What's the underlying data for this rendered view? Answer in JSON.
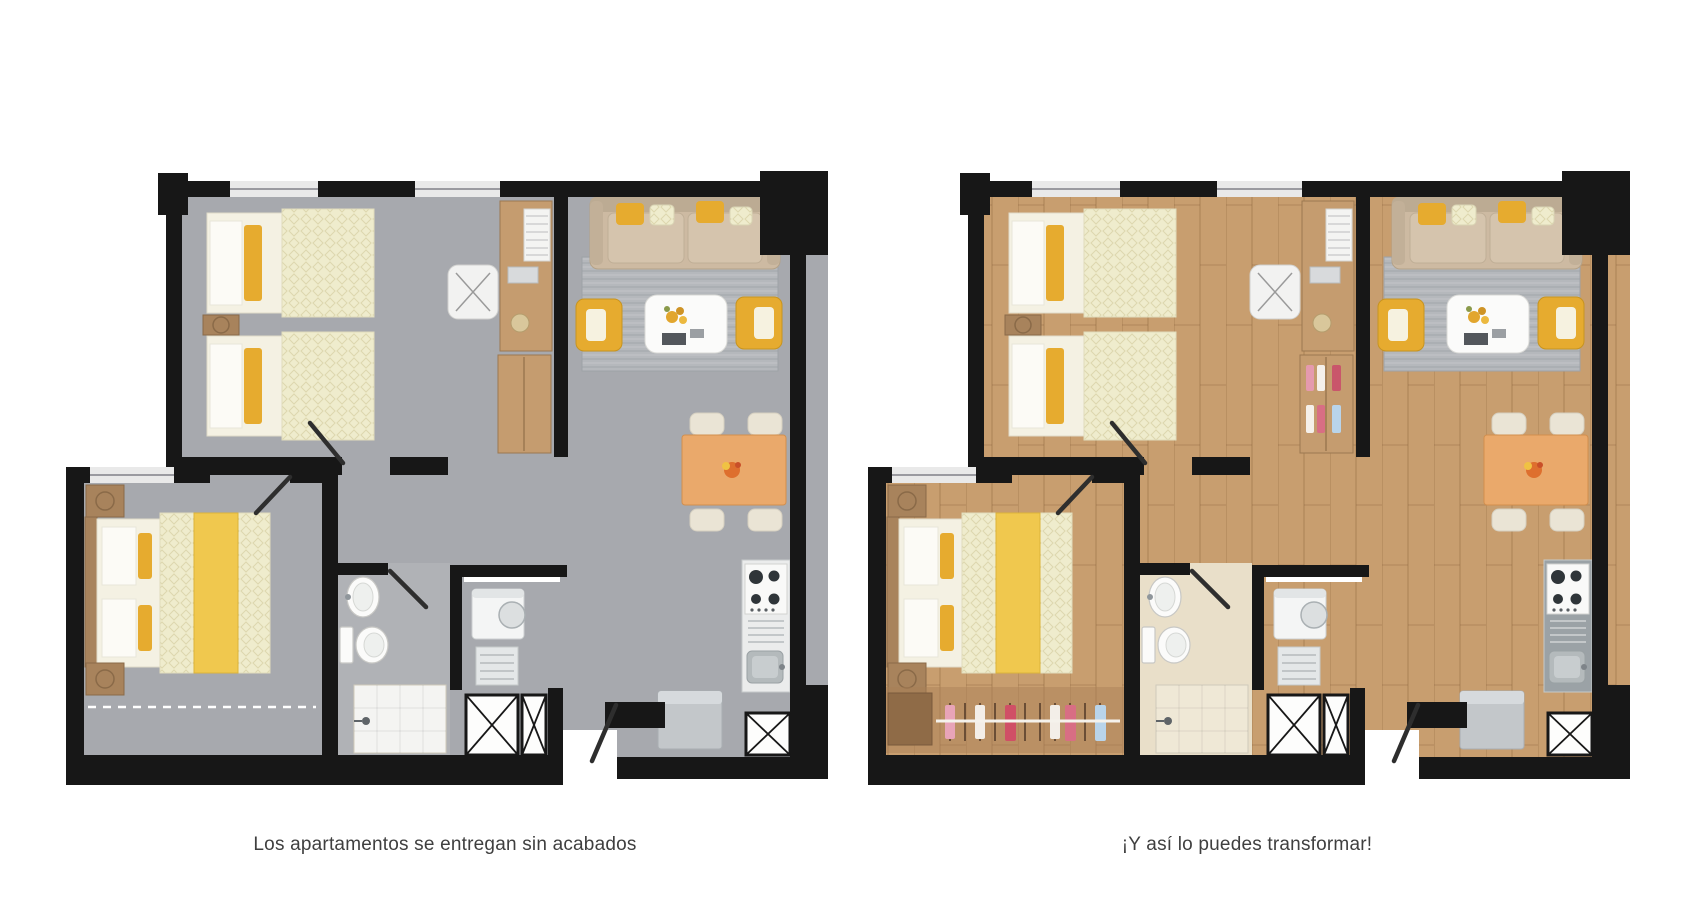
{
  "page": {
    "background": "#ffffff"
  },
  "palette": {
    "wall": "#171717",
    "accent": "#e6ab2f",
    "wood": "#c59c6f",
    "wood_dark": "#a8835c",
    "dining": "#eaa96b",
    "sofa": "#cdbaa2",
    "rug": "#b5b8bc",
    "linen": "#f4f1e3",
    "duvet": "#efeccd",
    "runner": "#f0c84e"
  },
  "plans": [
    {
      "id": "unfinished",
      "caption": "Los apartamentos se entregan sin acabados",
      "colors": {
        "floor": "#a7a9ae",
        "bath-floor": "#b0b2b6",
        "shower": "#f4f4f2",
        "counter": "#ebecec"
      }
    },
    {
      "id": "finished",
      "caption": "¡Y así lo puedes transformar!",
      "colors": {
        "floor": "#c89e6f",
        "bath-floor": "#e9dfc9",
        "shower": "#efe8d6",
        "counter": "#9ba2a6"
      }
    }
  ]
}
